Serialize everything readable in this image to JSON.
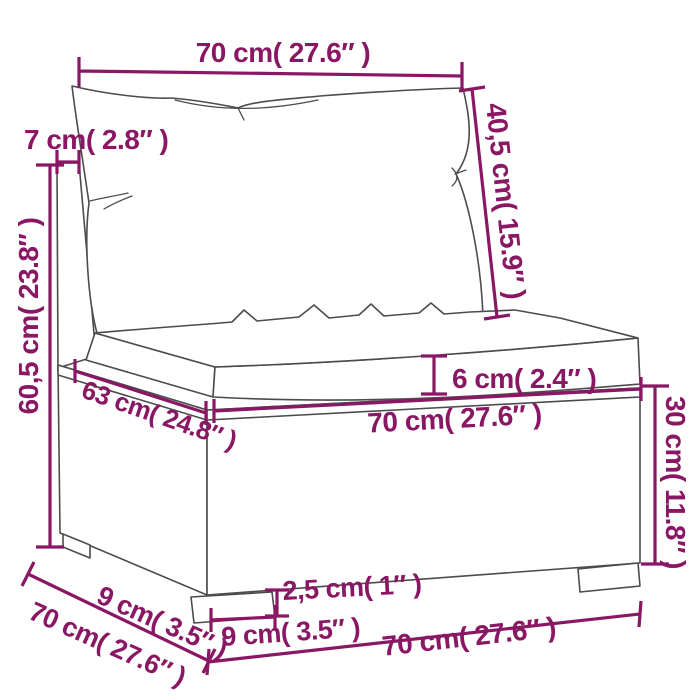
{
  "diagram": {
    "kind": "product-dimension-diagram",
    "subject": "poly-rattan sofa middle section with back pillow and seat cushion",
    "colors": {
      "dimension": "#8a1763",
      "outline": "#4c4c4c",
      "background": "#ffffff"
    },
    "dims": {
      "pillow_width": "70 cm( 27.6″ )",
      "back_thickness": "7 cm( 2.8″ )",
      "back_height": "40,5 cm( 15.9″ )",
      "total_height": "60,5 cm( 23.8″ )",
      "cushion_thickness": "6 cm( 2.4″ )",
      "seat_depth": "63 cm( 24.8″ )",
      "seat_width": "70 cm( 27.6″ )",
      "base_height": "30 cm( 11.8″ )",
      "total_depth": "70 cm( 27.6″ )",
      "leg_inset": "9 cm( 3.5″ )",
      "leg_height": "2,5 cm( 1″ )",
      "leg_width": "9 cm( 3.5″ )",
      "base_width": "70 cm( 27.6″ )"
    }
  }
}
